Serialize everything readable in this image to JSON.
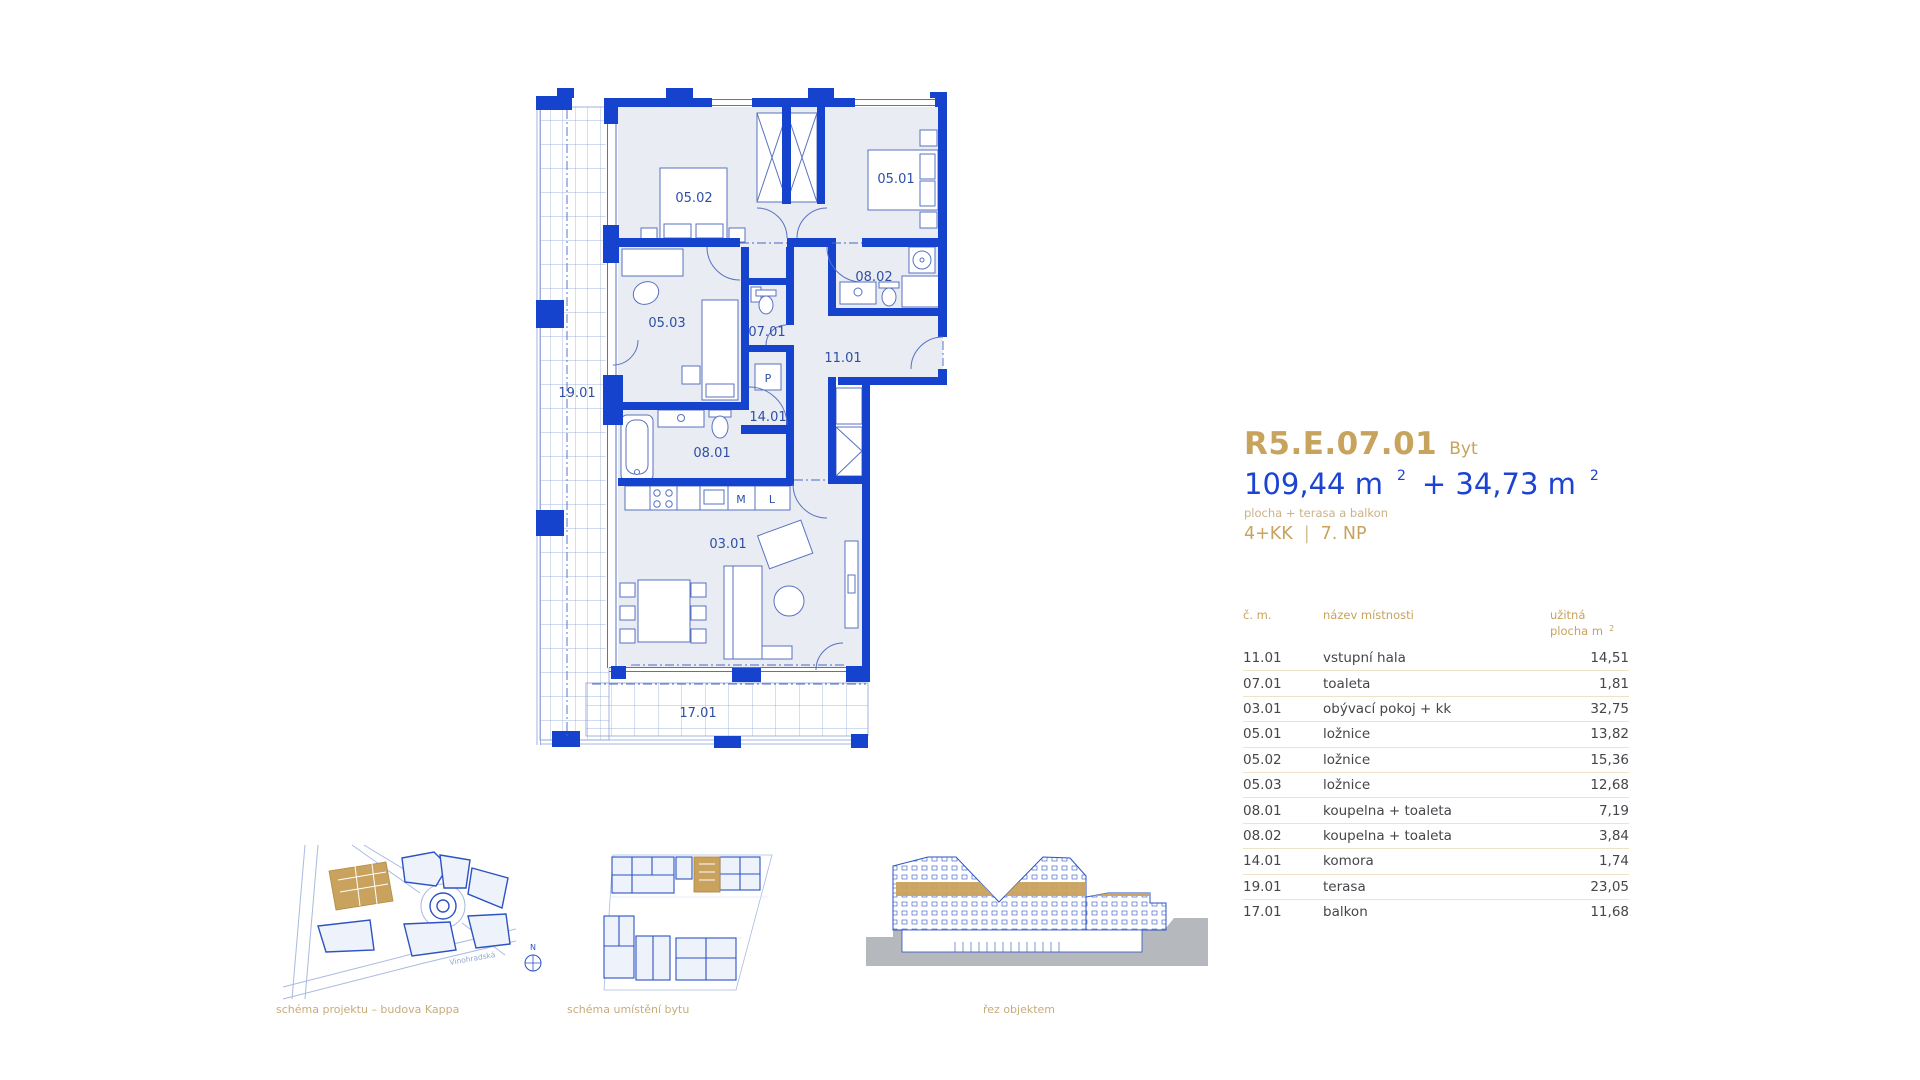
{
  "header": {
    "unit_code": "R5.E.07.01",
    "unit_type": "Byt",
    "area_value_1": "109,44 m",
    "area_sup_1": "2",
    "area_value_2": "+ 34,73 m",
    "area_sup_2": "2",
    "area_note": "plocha + terasa a balkon",
    "layout": "4+KK",
    "divider": "|",
    "floor": "7. NP"
  },
  "table": {
    "col_number": "č. m.",
    "col_name": "název místnosti",
    "col_area_1": "užitná",
    "col_area_2": "plocha m",
    "col_area_sup": "2",
    "rows": [
      {
        "number": "11.01",
        "name": "vstupní hala",
        "area": "14,51"
      },
      {
        "number": "07.01",
        "name": "toaleta",
        "area": "1,81"
      },
      {
        "number": "03.01",
        "name": "obývací pokoj + kk",
        "area": "32,75"
      },
      {
        "number": "05.01",
        "name": "ložnice",
        "area": "13,82"
      },
      {
        "number": "05.02",
        "name": "ložnice",
        "area": "15,36"
      },
      {
        "number": "05.03",
        "name": "ložnice",
        "area": "12,68"
      },
      {
        "number": "08.01",
        "name": "koupelna + toaleta",
        "area": "7,19"
      },
      {
        "number": "08.02",
        "name": "koupelna + toaleta",
        "area": "3,84"
      },
      {
        "number": "14.01",
        "name": "komora",
        "area": "1,74"
      },
      {
        "number": "19.01",
        "name": "terasa",
        "area": "23,05"
      },
      {
        "number": "17.01",
        "name": "balkon",
        "area": "11,68"
      }
    ]
  },
  "plan": {
    "labels": {
      "r0502": "05.02",
      "r0501": "05.01",
      "r0503": "05.03",
      "r0701": "07.01",
      "r0802": "08.02",
      "r1101": "11.01",
      "p": "P",
      "r1401": "14.01",
      "r0801": "08.01",
      "m": "M",
      "l": "L",
      "r0301": "03.01",
      "r1901": "19.01",
      "r1701": "17.01"
    }
  },
  "schematics": {
    "site_caption": "schéma projektu – budova Kappa",
    "unit_caption": "schéma umístění bytu",
    "section_caption": "řez objektem",
    "street": "Vinohradská",
    "compass": "N"
  },
  "colors": {
    "accent_gold": "#c7a35e",
    "plan_blue": "#1543cd",
    "area_blue": "#1c43d2"
  }
}
